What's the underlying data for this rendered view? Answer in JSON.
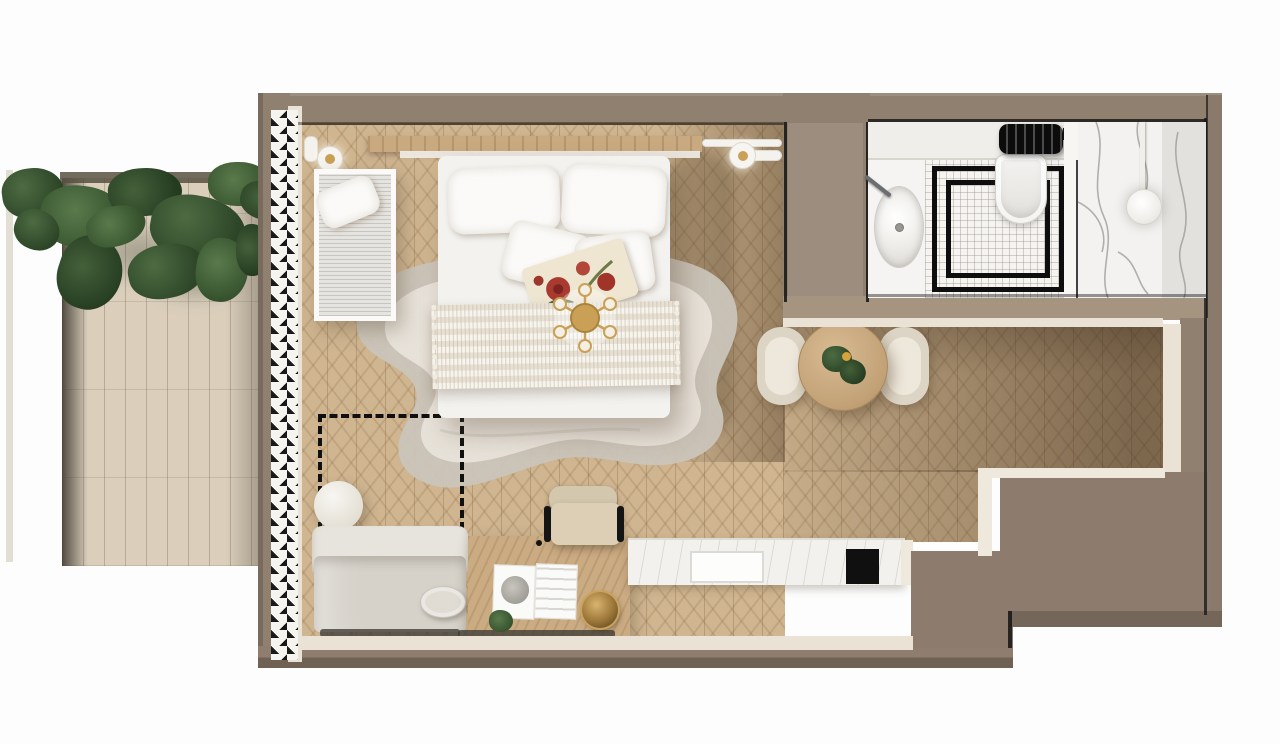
{
  "scene": {
    "kind": "studio apartment floor plan, photorealistic top-down 3D render",
    "no_visible_text": true
  },
  "rooms": {
    "terrace": {
      "label": "terrace with hanging ivy and stone deck"
    },
    "studio": {
      "label": "studio room with herringbone oak floor"
    },
    "bathroom": {
      "label": "bathroom with marble shower"
    }
  },
  "furniture": {
    "curtain": "floor-to-ceiling drapes along left glazing",
    "daybed": "white-framed daybed with ribbed cushion and pillow",
    "bed": "double bed with two large pillows, two small pillows, floral accent pillow and ribbed throw",
    "chandelier": "brass six-arm ceiling light over bed foot",
    "sconces": "pair of round wall lamps beside headboard",
    "rug": "organic-shaped two-tone grey rug",
    "marker": "black dashed planning marker with round side table",
    "sofa": "light grey two-seat sofa with round bolster",
    "desk": "wooden desk with open magazine, brass bowl and small plant",
    "desk_chair": "beige desk chair with black frame",
    "kitchenette": "white marble counter with sink and black cooktop",
    "dining_table": "round wooden dining table with plant",
    "dining_chairs": "two curved beige dining chairs"
  },
  "bathroom_fixtures": {
    "vanity": "vanity with oval basin and wall faucet",
    "toilet": "wall-hung toilet",
    "radiator": "black towel radiator",
    "shower_floor": "white mosaic floor with nested black border inlay",
    "partition": "glass partition",
    "shower_head": "round rain shower head",
    "walls": "white marble with grey veining"
  },
  "palette": {
    "background": "#fdfdfd",
    "wall": "#90806f",
    "wall_dark": "#6f6254",
    "wall_light": "#a49480",
    "trim": "#eae2d5",
    "floor": "#cfb590",
    "deck": "#dbcfbc",
    "rug_outer": "#cbc5ba",
    "rug_inner": "#e9e4db",
    "textile_white": "#f3f2ef",
    "brass": "#c9a055",
    "plant_green": "#3c5a33",
    "accent_black": "#141414",
    "marble": "#f4f3f0"
  }
}
